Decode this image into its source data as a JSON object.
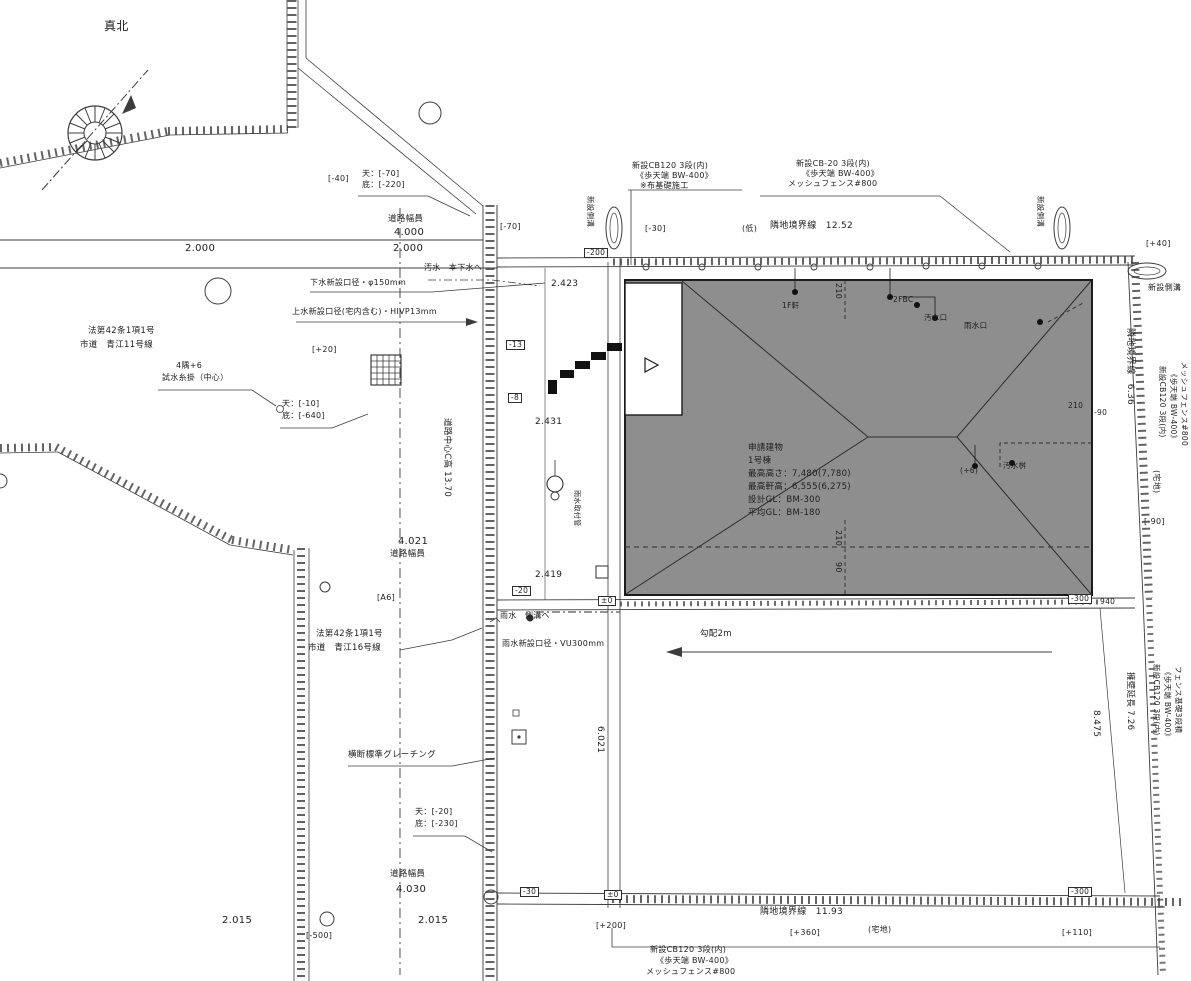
{
  "page": {
    "width": 1191,
    "height": 981,
    "background": "#ffffff",
    "kind": "site-plan-drawing"
  },
  "colors": {
    "line": "#3c3c3c",
    "hatch": "#3a3a3a",
    "building_fill": "#8e8e8e",
    "text": "#1e1e1e"
  },
  "compass": {
    "label": "真北"
  },
  "building_note": {
    "line1": "申請建物",
    "line2": "1号棟",
    "line3": "最高高さ：7,480(7,780)",
    "line4": "最高軒高：6,555(6,275)",
    "line5": "設計GL：BM-300",
    "line6": "平均GL：BM-180"
  },
  "labels": [
    {
      "name": "north-label",
      "text": "真北",
      "x": 104,
      "y": 20,
      "size": 12
    },
    {
      "name": "dim-2000-left",
      "text": "2.000",
      "x": 185,
      "y": 243,
      "size": 10
    },
    {
      "name": "dim-2000-right",
      "text": "2.000",
      "x": 393,
      "y": 243,
      "size": 10
    },
    {
      "name": "road-width-top-title",
      "text": "道路幅員",
      "x": 388,
      "y": 215,
      "size": 8.5
    },
    {
      "name": "road-width-top-value",
      "text": "4.000",
      "x": 394,
      "y": 227,
      "size": 10
    },
    {
      "name": "elev-top-upper",
      "text": "天：[-70]",
      "x": 362,
      "y": 170,
      "size": 8
    },
    {
      "name": "elev-top-lower",
      "text": "底：[-220]",
      "x": 362,
      "y": 181,
      "size": 8
    },
    {
      "name": "bracket-neg40",
      "text": "[-40]",
      "x": 328,
      "y": 175,
      "size": 8
    },
    {
      "name": "sewer-pipe-note",
      "text": "下水新設口径・φ150mm",
      "x": 310,
      "y": 279,
      "size": 8
    },
    {
      "name": "sewage-main-note",
      "text": "汚水　本下水へ",
      "x": 424,
      "y": 264,
      "size": 8
    },
    {
      "name": "water-pipe-note",
      "text": "上水新設口径(宅内含む)・HIVP13mm",
      "x": 292,
      "y": 308,
      "size": 8
    },
    {
      "name": "law-road-11-line1",
      "text": "法第42条1項1号",
      "x": 88,
      "y": 327,
      "size": 8.5
    },
    {
      "name": "law-road-11-line2",
      "text": "市道　青江11号線",
      "x": 80,
      "y": 341,
      "size": 8.5
    },
    {
      "name": "corner-note-line1",
      "text": "4隅+6",
      "x": 176,
      "y": 362,
      "size": 8
    },
    {
      "name": "corner-note-line2",
      "text": "試水糸掛（中心）",
      "x": 162,
      "y": 374,
      "size": 8
    },
    {
      "name": "bracket-plus20",
      "text": "[+20]",
      "x": 312,
      "y": 346,
      "size": 8
    },
    {
      "name": "elev-mid-upper",
      "text": "天：[-10]",
      "x": 282,
      "y": 400,
      "size": 8
    },
    {
      "name": "elev-mid-lower",
      "text": "底：[-640]",
      "x": 282,
      "y": 412,
      "size": 8
    },
    {
      "name": "road-center-height",
      "text": "道路中心C高 13.70",
      "x": 451,
      "y": 418,
      "size": 8.5,
      "rot": 90
    },
    {
      "name": "dim-2423",
      "text": "2.423",
      "x": 551,
      "y": 280,
      "size": 9
    },
    {
      "name": "box-neg200",
      "text": "-200",
      "x": 584,
      "y": 248,
      "size": 7.5,
      "box": true
    },
    {
      "name": "bracket-neg70",
      "text": "[-70]",
      "x": 500,
      "y": 223,
      "size": 8
    },
    {
      "name": "bracket-neg30-top",
      "text": "[-30]",
      "x": 645,
      "y": 225,
      "size": 8
    },
    {
      "name": "paren-low",
      "text": "(低)",
      "x": 742,
      "y": 225,
      "size": 8
    },
    {
      "name": "adj-boundary-top",
      "text": "隣地境界線　12.52",
      "x": 770,
      "y": 222,
      "size": 9
    },
    {
      "name": "note-tl-line1",
      "text": "新設CB120 3段(内)",
      "x": 632,
      "y": 162,
      "size": 8
    },
    {
      "name": "note-tl-line2",
      "text": "《歩天端 BW-400》",
      "x": 636,
      "y": 172,
      "size": 8
    },
    {
      "name": "note-tl-line3",
      "text": "※布基礎施工",
      "x": 640,
      "y": 182,
      "size": 8
    },
    {
      "name": "note-tr-line1",
      "text": "新設CB-20 3段(内)",
      "x": 796,
      "y": 160,
      "size": 8
    },
    {
      "name": "note-tr-line2",
      "text": "《歩天端 BW-400》",
      "x": 802,
      "y": 170,
      "size": 8
    },
    {
      "name": "note-tr-line3",
      "text": "メッシュフェンス#800",
      "x": 788,
      "y": 180,
      "size": 8
    },
    {
      "name": "gutter-left-vertical",
      "text": "新設側溝",
      "x": 594,
      "y": 196,
      "size": 7.5,
      "rot": 90
    },
    {
      "name": "gutter-right-vertical",
      "text": "新設側溝",
      "x": 1044,
      "y": 196,
      "size": 7.5,
      "rot": 90
    },
    {
      "name": "bracket-plus40-right",
      "text": "[+40]",
      "x": 1146,
      "y": 240,
      "size": 8
    },
    {
      "name": "gutter-right-h",
      "text": "新設側溝",
      "x": 1148,
      "y": 284,
      "size": 8
    },
    {
      "name": "box-neg13",
      "text": "-13",
      "x": 506,
      "y": 340,
      "size": 7.5,
      "box": true
    },
    {
      "name": "box-neg8",
      "text": "-8",
      "x": 508,
      "y": 393,
      "size": 7.5,
      "box": true
    },
    {
      "name": "dim-2431",
      "text": "2.431",
      "x": 535,
      "y": 418,
      "size": 9
    },
    {
      "name": "dim-210-rooftop",
      "text": "210",
      "x": 842,
      "y": 283,
      "size": 8,
      "rot": 90
    },
    {
      "name": "roof-point-1",
      "text": "1F軒",
      "x": 782,
      "y": 302,
      "size": 7.5
    },
    {
      "name": "roof-point-2",
      "text": "2FBC",
      "x": 893,
      "y": 296,
      "size": 7.5
    },
    {
      "name": "roof-point-3",
      "text": "汚水口",
      "x": 924,
      "y": 314,
      "size": 7.5
    },
    {
      "name": "roof-point-4",
      "text": "雨水口",
      "x": 964,
      "y": 322,
      "size": 7.5
    },
    {
      "name": "dim-210-right",
      "text": "210",
      "x": 1068,
      "y": 402,
      "size": 7.5
    },
    {
      "name": "dim-90-right",
      "text": "-90",
      "x": 1094,
      "y": 409,
      "size": 7.5
    },
    {
      "name": "bldg-note-line1",
      "text": "申請建物",
      "x": 748,
      "y": 444,
      "size": 8.5
    },
    {
      "name": "bldg-note-line2",
      "text": "1号棟",
      "x": 748,
      "y": 457,
      "size": 8.5
    },
    {
      "name": "bldg-note-line3",
      "text": "最高高さ：7,480(7,780)",
      "x": 748,
      "y": 470,
      "size": 8.5
    },
    {
      "name": "bldg-note-line4",
      "text": "最高軒高：6,555(6,275)",
      "x": 748,
      "y": 483,
      "size": 8.5
    },
    {
      "name": "bldg-note-line5",
      "text": "設計GL：BM-300",
      "x": 748,
      "y": 496,
      "size": 8.5
    },
    {
      "name": "bldg-note-line6",
      "text": "平均GL：BM-180",
      "x": 748,
      "y": 509,
      "size": 8.5
    },
    {
      "name": "point-plus6",
      "text": "(+6)",
      "x": 960,
      "y": 467,
      "size": 7.5
    },
    {
      "name": "point-masu",
      "text": "汚水桝",
      "x": 1003,
      "y": 462,
      "size": 7.5
    },
    {
      "name": "rain-branch-vertical",
      "text": "雨水取付管",
      "x": 580,
      "y": 490,
      "size": 7,
      "rot": 90
    },
    {
      "name": "dim-210-bottom",
      "text": "210",
      "x": 842,
      "y": 530,
      "size": 8,
      "rot": 90
    },
    {
      "name": "dim-90-bottom",
      "text": "90",
      "x": 842,
      "y": 562,
      "size": 8,
      "rot": 90
    },
    {
      "name": "dim-2419",
      "text": "2.419",
      "x": 535,
      "y": 571,
      "size": 9
    },
    {
      "name": "box-neg20-mid",
      "text": "-20",
      "x": 512,
      "y": 586,
      "size": 7.5,
      "box": true
    },
    {
      "name": "box-pm0-mid",
      "text": "±0",
      "x": 598,
      "y": 596,
      "size": 7.5,
      "box": true
    },
    {
      "name": "box-neg300-mid",
      "text": "-300",
      "x": 1068,
      "y": 594,
      "size": 7.5,
      "box": true
    },
    {
      "name": "dim-940",
      "text": "940",
      "x": 1100,
      "y": 598,
      "size": 7.5
    },
    {
      "name": "dim-4021",
      "text": "4.021",
      "x": 398,
      "y": 536,
      "size": 10
    },
    {
      "name": "road-width-mid-title",
      "text": "道路幅員",
      "x": 390,
      "y": 550,
      "size": 8.5
    },
    {
      "name": "bracket-a6",
      "text": "[A6]",
      "x": 377,
      "y": 594,
      "size": 8
    },
    {
      "name": "law-road-16-line1",
      "text": "法第42条1項1号",
      "x": 316,
      "y": 630,
      "size": 8.5
    },
    {
      "name": "law-road-16-line2",
      "text": "市道　青江16号線",
      "x": 308,
      "y": 644,
      "size": 8.5
    },
    {
      "name": "rain-gutter-note",
      "text": "雨水　側溝へ",
      "x": 500,
      "y": 612,
      "size": 8
    },
    {
      "name": "rain-pipe-note",
      "text": "雨水新設口径・VU300mm",
      "x": 502,
      "y": 640,
      "size": 8
    },
    {
      "name": "slope-label",
      "text": "勾配2m",
      "x": 700,
      "y": 630,
      "size": 8.5
    },
    {
      "name": "dim-6021",
      "text": "6.021",
      "x": 604,
      "y": 726,
      "size": 9,
      "rot": 90
    },
    {
      "name": "grating-note",
      "text": "横断標準グレーチング",
      "x": 348,
      "y": 751,
      "size": 8.5
    },
    {
      "name": "elev-bot-upper",
      "text": "天：[-20]",
      "x": 415,
      "y": 808,
      "size": 8
    },
    {
      "name": "elev-bot-lower",
      "text": "底：[-230]",
      "x": 415,
      "y": 820,
      "size": 8
    },
    {
      "name": "road-width-bot-title",
      "text": "道路幅員",
      "x": 390,
      "y": 870,
      "size": 8.5
    },
    {
      "name": "dim-4030",
      "text": "4.030",
      "x": 396,
      "y": 884,
      "size": 10
    },
    {
      "name": "dim-2015-left",
      "text": "2.015",
      "x": 222,
      "y": 915,
      "size": 10
    },
    {
      "name": "dim-2015-right",
      "text": "2.015",
      "x": 418,
      "y": 915,
      "size": 10
    },
    {
      "name": "bracket-neg500",
      "text": "[-500]",
      "x": 306,
      "y": 932,
      "size": 8
    },
    {
      "name": "box-neg30-bot",
      "text": "-30",
      "x": 520,
      "y": 887,
      "size": 7.5,
      "box": true
    },
    {
      "name": "box-pm0-bot",
      "text": "±0",
      "x": 604,
      "y": 890,
      "size": 7.5,
      "box": true
    },
    {
      "name": "bracket-plus200",
      "text": "[+200]",
      "x": 596,
      "y": 922,
      "size": 8
    },
    {
      "name": "adj-boundary-bot",
      "text": "隣地境界線　11.93",
      "x": 760,
      "y": 908,
      "size": 9
    },
    {
      "name": "bracket-plus360",
      "text": "[+360]",
      "x": 790,
      "y": 929,
      "size": 8
    },
    {
      "name": "paren-takuchi-bot",
      "text": "(宅地)",
      "x": 868,
      "y": 926,
      "size": 8
    },
    {
      "name": "bracket-plus110",
      "text": "[+110]",
      "x": 1062,
      "y": 929,
      "size": 8
    },
    {
      "name": "box-neg300-bot",
      "text": "-300",
      "x": 1068,
      "y": 887,
      "size": 7.5,
      "box": true
    },
    {
      "name": "note-bot-line1",
      "text": "新設CB120 3段(内)",
      "x": 650,
      "y": 946,
      "size": 8
    },
    {
      "name": "note-bot-line2",
      "text": "《歩天端 BW-400》",
      "x": 656,
      "y": 957,
      "size": 8
    },
    {
      "name": "note-bot-line3",
      "text": "メッシュフェンス#800",
      "x": 646,
      "y": 968,
      "size": 8
    },
    {
      "name": "adj-boundary-right",
      "text": "隣地境界線　6.36",
      "x": 1134,
      "y": 328,
      "size": 9,
      "rot": 90
    },
    {
      "name": "right-note-line1",
      "text": "新設CB120 3段(内)",
      "x": 1166,
      "y": 366,
      "size": 7.5,
      "rot": 90
    },
    {
      "name": "right-note-line2",
      "text": "《歩天端 BW-400》",
      "x": 1177,
      "y": 370,
      "size": 7.5,
      "rot": 90
    },
    {
      "name": "right-note-line3",
      "text": "メッシュフェンス#800",
      "x": 1188,
      "y": 362,
      "size": 7.5,
      "rot": 90
    },
    {
      "name": "paren-takuchi-right",
      "text": "(宅地)",
      "x": 1160,
      "y": 470,
      "size": 8,
      "rot": 90
    },
    {
      "name": "bracket-neg90-right",
      "text": "[-90]",
      "x": 1144,
      "y": 518,
      "size": 8
    },
    {
      "name": "wall-length-right",
      "text": "擁壁延長 7.26",
      "x": 1134,
      "y": 672,
      "size": 8.5,
      "rot": 90
    },
    {
      "name": "dim-8475",
      "text": "8.475",
      "x": 1100,
      "y": 710,
      "size": 9,
      "rot": 90
    },
    {
      "name": "right-note2-line1",
      "text": "新設CB120 3段(内)",
      "x": 1160,
      "y": 664,
      "size": 7.5,
      "rot": 90
    },
    {
      "name": "right-note2-line2",
      "text": "《歩天端 BW-400》",
      "x": 1171,
      "y": 668,
      "size": 7.5,
      "rot": 90
    },
    {
      "name": "right-note2-line3",
      "text": "フェンス基礎3段積",
      "x": 1182,
      "y": 666,
      "size": 7.5,
      "rot": 90
    }
  ]
}
